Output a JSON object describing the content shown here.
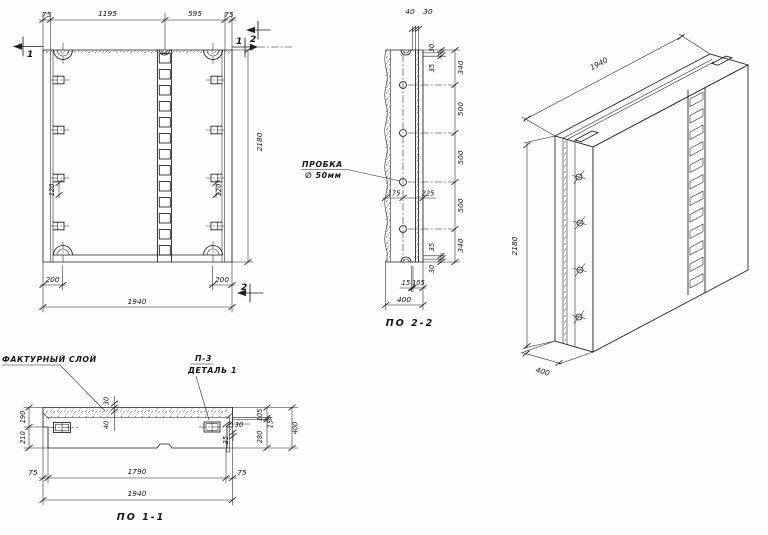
{
  "front_view": {
    "dim_75_left": "75",
    "dim_1195": "1195",
    "dim_595": "595",
    "dim_75_right": "75",
    "dim_height": "2180",
    "dim_200_left": "200",
    "dim_200_right": "200",
    "dim_width": "1940",
    "dim_120_left": "120",
    "dim_120_right": "120",
    "mark_1_left": "1",
    "mark_1_right": "1",
    "mark_2_top": "2",
    "mark_2_bottom": "2"
  },
  "section_2_2": {
    "title": "ПО 2-2",
    "dim_40": "40",
    "dim_30_top": "30",
    "right_dims": [
      "30",
      "35",
      "340",
      "500",
      "500",
      "500",
      "340",
      "35",
      "30"
    ],
    "dim_175": "175",
    "dim_225": "225",
    "dim_15": "15",
    "dim_105": "105",
    "dim_400": "400",
    "plug_label": "ПРОБКА",
    "plug_size": "∅ 50мм"
  },
  "isometric": {
    "dim_length": "1940",
    "dim_height": "2180",
    "dim_depth": "400"
  },
  "section_1_1": {
    "title": "ПО 1-1",
    "facing_layer_label": "ФАКТУРНЫЙ СЛОЙ",
    "detail_ref": "П-3",
    "detail_label": "ДЕТАЛЬ 1",
    "dim_190": "190",
    "dim_210": "210",
    "dim_30_mid": "30",
    "dim_40_mid": "40",
    "dim_30_right": "30",
    "dim_35_right": "35",
    "dim_105": "105",
    "dim_15": "15",
    "dim_280": "280",
    "dim_400": "400",
    "dim_75_left": "75",
    "dim_1790": "1790",
    "dim_75_right": "75",
    "dim_1940": "1940"
  }
}
